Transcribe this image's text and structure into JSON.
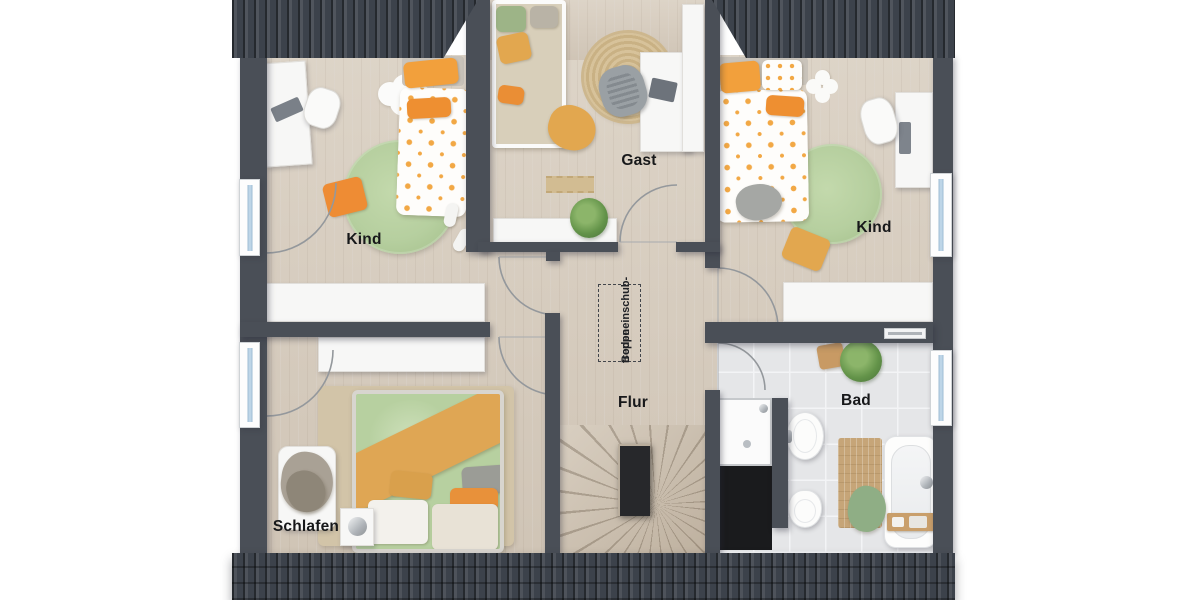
{
  "rooms": {
    "kind_left": {
      "label": "Kind"
    },
    "gast": {
      "label": "Gast"
    },
    "kind_right": {
      "label": "Kind"
    },
    "flur": {
      "label": "Flur"
    },
    "bad": {
      "label": "Bad"
    },
    "schlafen": {
      "label": "Schlafen"
    }
  },
  "annotations": {
    "attic_stairs_line1": "Bodeneinschub-",
    "attic_stairs_line2": "treppe"
  },
  "colors": {
    "background": "#ffffff",
    "wall": "#4a4f57",
    "roof": "#3c424b",
    "floor_wood": "#d9cfc1",
    "floor_tile": "#e5e6e8",
    "window_glass": "#bdd5e7",
    "arc_stroke": "#94989c",
    "accent_orange": "#f2a03c",
    "accent_green": "#b6cf9f",
    "accent_mustard": "#e2a74f",
    "label_text": "#17181a"
  }
}
